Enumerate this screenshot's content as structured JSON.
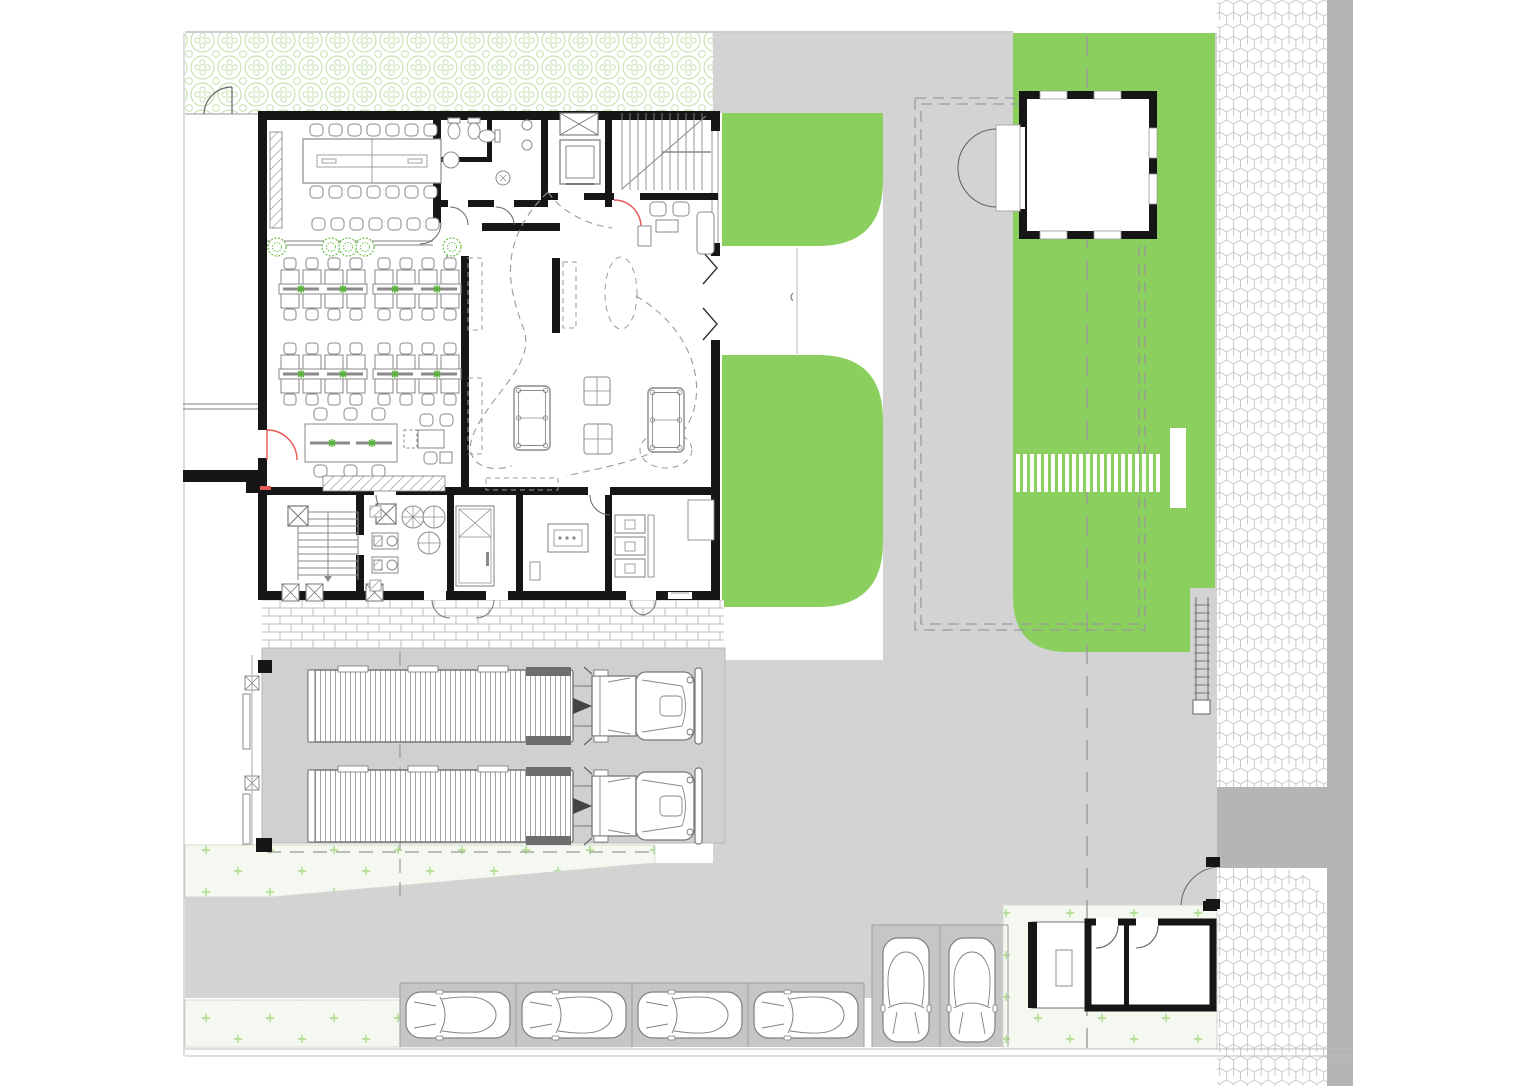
{
  "title": "site-floor-plan",
  "colors": {
    "background": "#ffffff",
    "wall": "#161616",
    "lawn": "#8bd05f",
    "court": "#d3d3d3",
    "truck_yard": "#d0d0d0",
    "road_dark": "#b5b5b5",
    "parking_stall": "#c6c6c6",
    "lawn_light": "#f5f7f1",
    "plus_mark": "#a6db86",
    "hedge_stroke": "#c6e3b2",
    "hex_stroke": "#c9c9c9",
    "brick_stroke": "#bcbcbc",
    "furniture_stroke": "#8a8a8a",
    "dash_line": "#9a9a9a",
    "door_red": "#e85752",
    "plant_green": "#6cc24a",
    "vehicle_stroke": "#808080"
  },
  "inventory": {
    "semi_trucks": 2,
    "cars_parked_horizontal": 4,
    "cars_parked_vertical": 2,
    "office_desk_clusters": 4,
    "conference_seats": 22,
    "pool_tables": 2,
    "gatehouses": 2,
    "elevators": 1,
    "staircases": 2,
    "crosswalk_stripes": 21
  },
  "legend": {
    "green_areas": "lawn",
    "hatched_strip": "hedge planting",
    "hex_strip": "sidewalk paving",
    "gray_areas": "driveway / yard"
  }
}
